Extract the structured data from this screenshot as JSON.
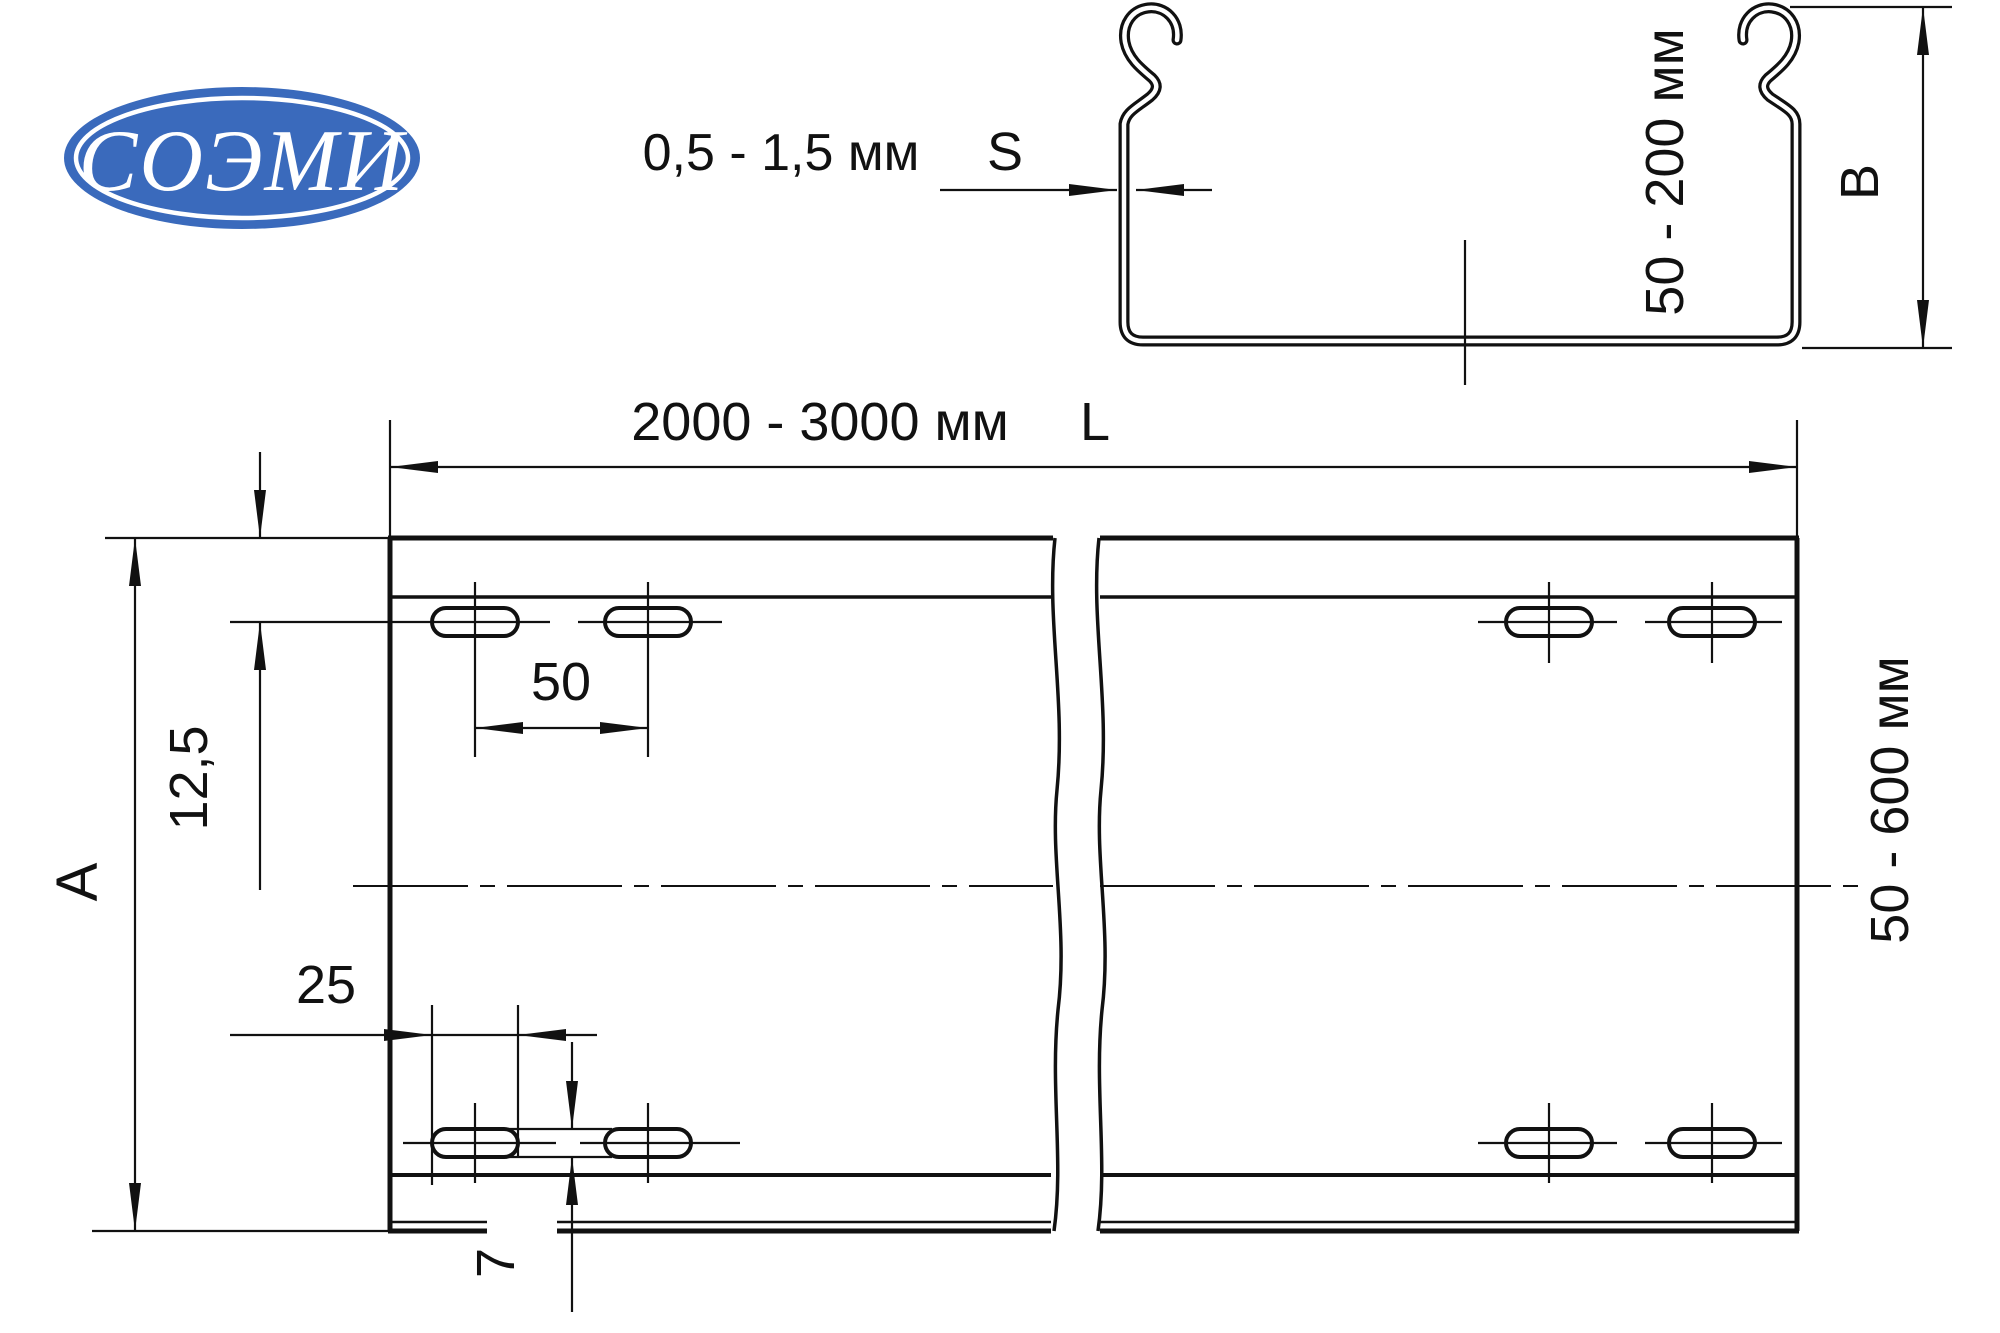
{
  "logo": {
    "text": "СОЭМИ",
    "bg_color": "#3a6abc",
    "text_color": "#ffffff"
  },
  "section": {
    "thickness_range": "0,5 - 1,5 мм",
    "thickness_symbol": "S",
    "height_range": "50 - 200 мм",
    "height_symbol": "B"
  },
  "plan": {
    "length_range": "2000 - 3000 мм",
    "length_symbol": "L",
    "width_symbol": "A",
    "width_range": "50 - 600 мм",
    "edge_to_slot_row": "12,5",
    "slot_pitch": "50",
    "slot_length": "25",
    "slot_width": "7"
  },
  "line_color": "#111111"
}
